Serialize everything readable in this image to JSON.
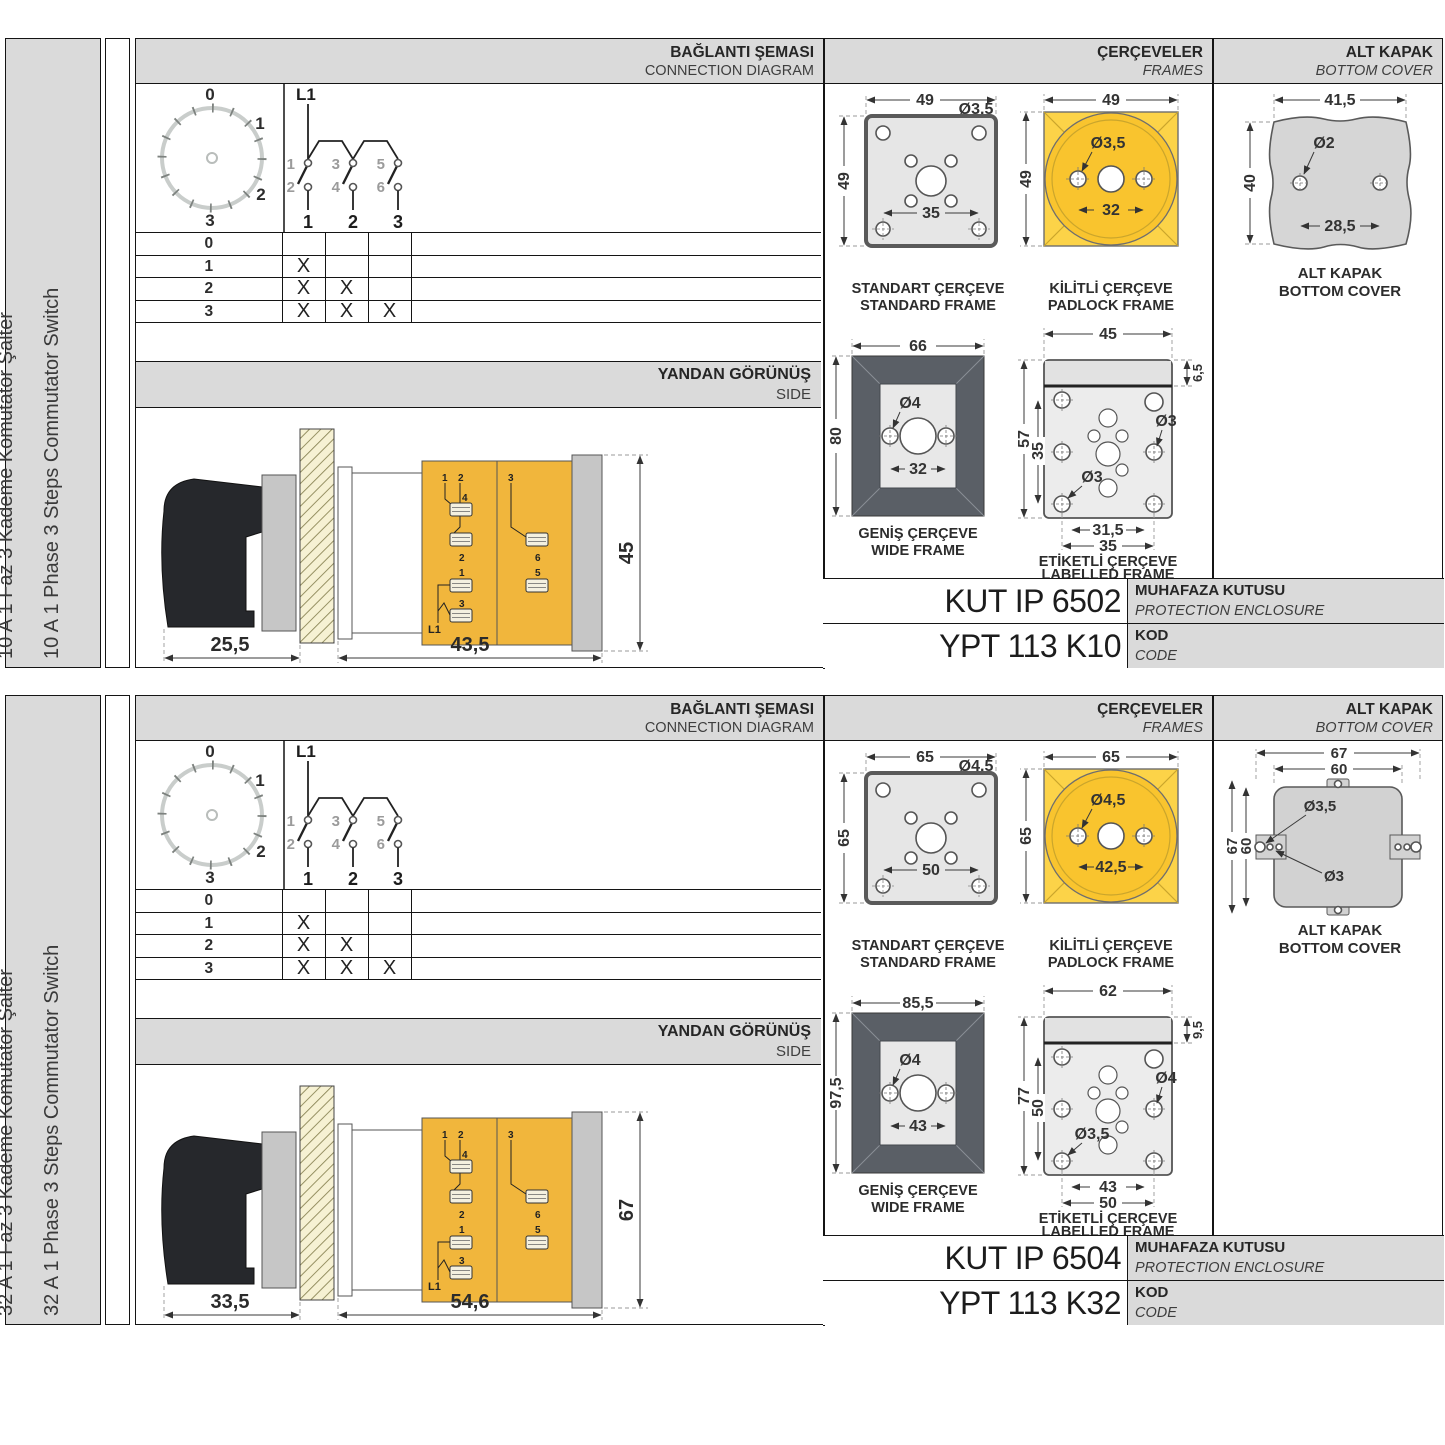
{
  "sections": [
    {
      "label_tr": "10 A 1 Faz 3 Kademe Komütatör Şalter",
      "label_en": "10 A 1 Phase 3 Steps Commutator Switch",
      "hdr": {
        "conn_tr": "BAĞLANTI ŞEMASI",
        "conn_en": "CONNECTION DIAGRAM",
        "frames_tr": "ÇERÇEVELER",
        "frames_en": "FRAMES",
        "cover_tr": "ALT KAPAK",
        "cover_en": "BOTTOM COVER"
      },
      "dial": {
        "p0": "0",
        "p1": "1",
        "p2": "2",
        "p3": "3"
      },
      "sch": {
        "l1": "L1",
        "c1": "1",
        "c2": "2",
        "c3": "3",
        "c4": "4",
        "c5": "5",
        "c6": "6",
        "o1": "1",
        "o2": "2",
        "o3": "3"
      },
      "table": {
        "rows": [
          {
            "label": "0",
            "c": [
              "",
              "",
              ""
            ]
          },
          {
            "label": "1",
            "c": [
              "X",
              "",
              ""
            ]
          },
          {
            "label": "2",
            "c": [
              "X",
              "X",
              ""
            ]
          },
          {
            "label": "3",
            "c": [
              "X",
              "X",
              "X"
            ]
          }
        ]
      },
      "side": {
        "title_tr": "YANDAN GÖRÜNÜŞ",
        "title_en": "SIDE",
        "d_handle": "25,5",
        "d_body": "43,5",
        "d_height": "45",
        "t": [
          "1",
          "2",
          "3",
          "4",
          "2",
          "6",
          "1",
          "5",
          "3",
          "L1"
        ]
      },
      "std": {
        "w": "49",
        "h": "49",
        "hole": "Ø3,5",
        "pitch": "35",
        "tr": "STANDART ÇERÇEVE",
        "en": "STANDARD FRAME"
      },
      "pad": {
        "w": "49",
        "h": "49",
        "hole": "Ø3,5",
        "pitch": "32",
        "tr": "KİLİTLİ ÇERÇEVE",
        "en": "PADLOCK FRAME"
      },
      "wide": {
        "w": "66",
        "h": "80",
        "hole": "Ø4",
        "pitch": "32",
        "tr": "GENİŞ ÇERÇEVE",
        "en": "WIDE FRAME"
      },
      "lbl": {
        "w": "45",
        "tab": "6,5",
        "h": "57",
        "ih": "35",
        "hole_r": "Ø3",
        "hole_l": "Ø3",
        "p1": "31,5",
        "p2": "35",
        "tr": "ETİKETLİ ÇERÇEVE",
        "en": "LABELLED FRAME"
      },
      "cover": {
        "w": "41,5",
        "h": "40",
        "hole": "Ø2",
        "pitch": "28,5",
        "tr": "ALT KAPAK",
        "en": "BOTTOM COVER"
      },
      "codes": {
        "enclosure": "KUT IP 6502",
        "enc_tr": "MUHAFAZA KUTUSU",
        "enc_en": "PROTECTION ENCLOSURE",
        "code": "YPT 113 K10",
        "code_tr": "KOD",
        "code_en": "CODE"
      }
    },
    {
      "label_tr": "32 A 1 Faz 3 Kademe Komütatör Şalter",
      "label_en": "32 A 1 Phase 3 Steps Commutator Switch",
      "hdr": {
        "conn_tr": "BAĞLANTI ŞEMASI",
        "conn_en": "CONNECTION DIAGRAM",
        "frames_tr": "ÇERÇEVELER",
        "frames_en": "FRAMES",
        "cover_tr": "ALT KAPAK",
        "cover_en": "BOTTOM COVER"
      },
      "dial": {
        "p0": "0",
        "p1": "1",
        "p2": "2",
        "p3": "3"
      },
      "sch": {
        "l1": "L1",
        "c1": "1",
        "c2": "2",
        "c3": "3",
        "c4": "4",
        "c5": "5",
        "c6": "6",
        "o1": "1",
        "o2": "2",
        "o3": "3"
      },
      "table": {
        "rows": [
          {
            "label": "0",
            "c": [
              "",
              "",
              ""
            ]
          },
          {
            "label": "1",
            "c": [
              "X",
              "",
              ""
            ]
          },
          {
            "label": "2",
            "c": [
              "X",
              "X",
              ""
            ]
          },
          {
            "label": "3",
            "c": [
              "X",
              "X",
              "X"
            ]
          }
        ]
      },
      "side": {
        "title_tr": "YANDAN GÖRÜNÜŞ",
        "title_en": "SIDE",
        "d_handle": "33,5",
        "d_body": "54,6",
        "d_height": "67",
        "t": [
          "1",
          "2",
          "3",
          "4",
          "2",
          "6",
          "1",
          "5",
          "3",
          "L1"
        ]
      },
      "std": {
        "w": "65",
        "h": "65",
        "hole": "Ø4,5",
        "pitch": "50",
        "tr": "STANDART ÇERÇEVE",
        "en": "STANDARD FRAME"
      },
      "pad": {
        "w": "65",
        "h": "65",
        "hole": "Ø4,5",
        "pitch": "42,5",
        "tr": "KİLİTLİ ÇERÇEVE",
        "en": "PADLOCK FRAME"
      },
      "wide": {
        "w": "85,5",
        "h": "97,5",
        "hole": "Ø4",
        "pitch": "43",
        "tr": "GENİŞ ÇERÇEVE",
        "en": "WIDE FRAME"
      },
      "lbl": {
        "w": "62",
        "tab": "9,5",
        "h": "77",
        "ih": "50",
        "hole_r": "Ø4",
        "hole_l": "Ø3,5",
        "p1": "43",
        "p2": "50",
        "tr": "ETİKETLİ ÇERÇEVE",
        "en": "LABELLED FRAME"
      },
      "cover": {
        "w": "67",
        "iw": "60",
        "h": "67",
        "ih": "60",
        "hole1": "Ø3,5",
        "hole2": "Ø3",
        "tr": "ALT KAPAK",
        "en": "BOTTOM COVER"
      },
      "codes": {
        "enclosure": "KUT IP 6504",
        "enc_tr": "MUHAFAZA KUTUSU",
        "enc_en": "PROTECTION ENCLOSURE",
        "code": "YPT 113 K32",
        "code_tr": "KOD",
        "code_en": "CODE"
      }
    }
  ]
}
